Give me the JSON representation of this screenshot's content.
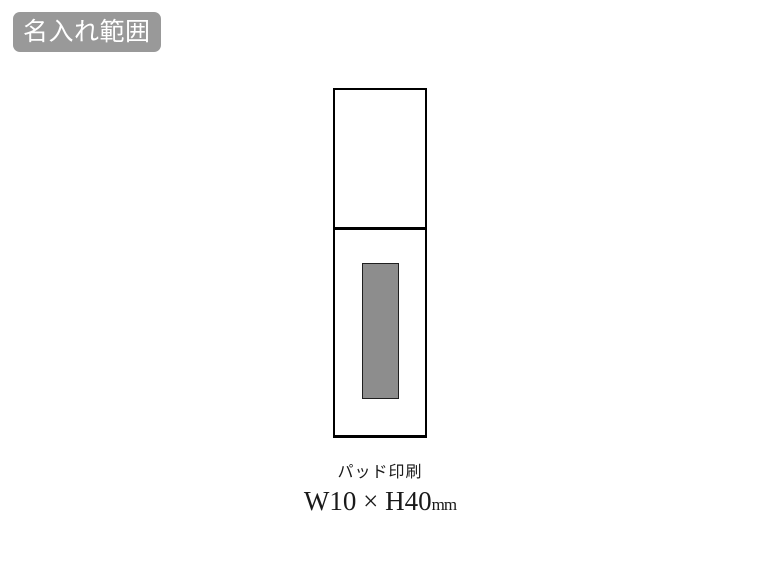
{
  "page": {
    "background_color": "#ffffff",
    "description": "Product imprint area diagram"
  },
  "badge": {
    "label": "名入れ範囲",
    "bg_color": "#999999",
    "text_color": "#ffffff"
  },
  "diagram": {
    "product": "stick-container-outline",
    "outline_color": "#000000",
    "print_area": {
      "fill_color": "#8d8d8d",
      "border_color": "#1f1f1f"
    }
  },
  "caption": {
    "method": "パッド印刷",
    "size": "W10 × H40",
    "unit": "mm"
  }
}
